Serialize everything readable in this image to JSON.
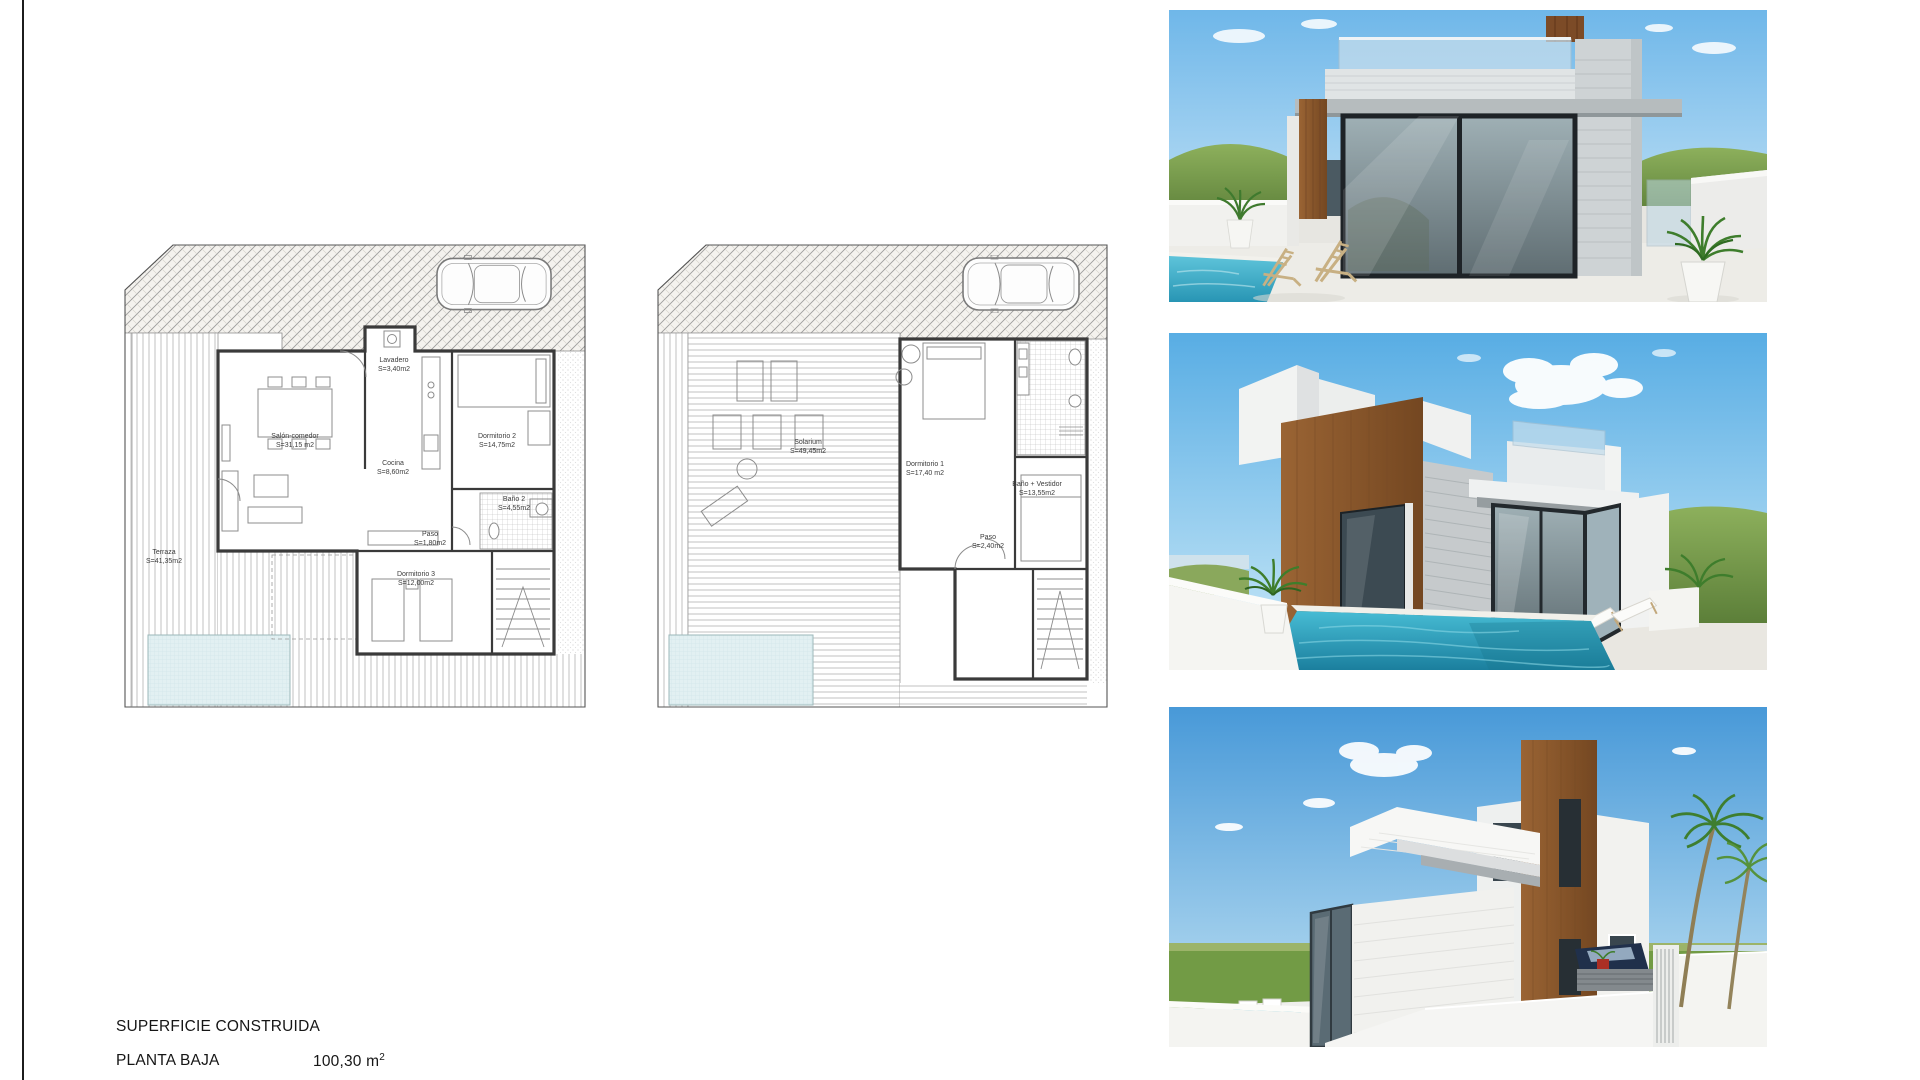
{
  "page": {
    "background": "#ffffff",
    "sheet_border_color": "#1c1c1c"
  },
  "plans": {
    "planta_baja": {
      "rooms": [
        {
          "label": "Salón-comedor",
          "area": "S=31,15 m2"
        },
        {
          "label": "Cocina",
          "area": "S=8,60m2"
        },
        {
          "label": "Lavadero",
          "area": "S=3,40m2"
        },
        {
          "label": "Dormitorio 2",
          "area": "S=14,75m2"
        },
        {
          "label": "Baño 2",
          "area": "S=4,55m2"
        },
        {
          "label": "Paso",
          "area": "S=1,80m2"
        },
        {
          "label": "Dormitorio 3",
          "area": "S=12,00m2"
        },
        {
          "label": "Terraza",
          "area": "S=41,35m2"
        }
      ]
    },
    "planta_primera": {
      "rooms": [
        {
          "label": "Solarium",
          "area": "S=49,45m2"
        },
        {
          "label": "Dormitorio 1",
          "area": "S=17,40 m2"
        },
        {
          "label": "Baño + Vestidor",
          "area": "S=13,55m2"
        },
        {
          "label": "Paso",
          "area": "S=2,40m2"
        }
      ]
    }
  },
  "summary": {
    "title": "SUPERFICIE CONSTRUIDA",
    "rows": [
      {
        "label": "PLANTA BAJA",
        "value": "100,30 m",
        "sup": "2"
      },
      {
        "label": "PLANTA PRIMERA",
        "value": "",
        "sup": ""
      }
    ]
  },
  "colors": {
    "plan_pool": "#dfeef1",
    "render_pool": "#2f9cbd",
    "wood_cladding": "#8a5a33",
    "sky": "#5fb0e6",
    "hills": "#7ba04e"
  }
}
